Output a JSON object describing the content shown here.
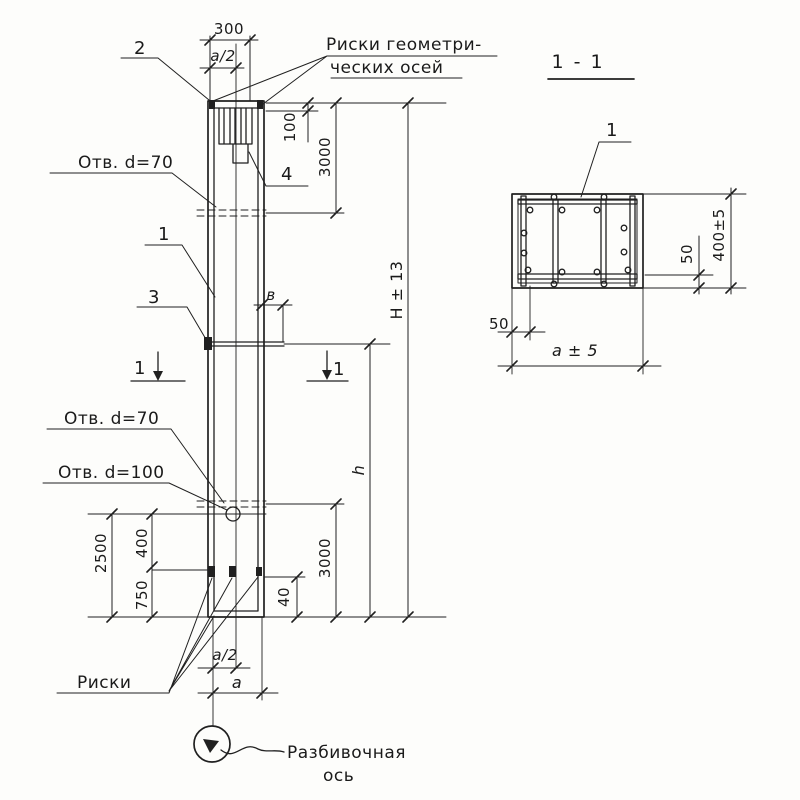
{
  "colors": {
    "ink": "#202020",
    "paper": "#fdfdfb"
  },
  "main_view": {
    "callouts": {
      "mark_2": "2",
      "axes_note_line1": "Риски геометри-",
      "axes_note_line2": "ческих осей",
      "mark_4": "4",
      "hole_top": "Отв. d=70",
      "mark_1": "1",
      "mark_3": "3",
      "hole_mid": "Отв. d=70",
      "hole_low": "Отв. d=100",
      "marks_note": "Риски",
      "layout_axis_line1": "Разбивочная",
      "layout_axis_line2": "ось"
    },
    "cut": {
      "left": "1",
      "right": "1"
    },
    "dims": {
      "top_width": "300",
      "top_half_width": "a/2",
      "head_depth": "100",
      "top_hole_offset": "3000",
      "total_height": "H ± 13",
      "joint_offset_b": "в",
      "lower_height": "h",
      "hole70_bottom": "3000",
      "hole100_bottom": "2500",
      "hole_to_mark": "400",
      "mark_to_bottom": "750",
      "edge_mark_offset": "40",
      "bottom_half_width": "a/2",
      "bottom_width": "a"
    }
  },
  "section_view": {
    "title": "1 - 1",
    "mark_1": "1",
    "dims": {
      "height": "400±5",
      "cover_bottom": "50",
      "cover_left": "50",
      "width": "a ± 5"
    }
  }
}
